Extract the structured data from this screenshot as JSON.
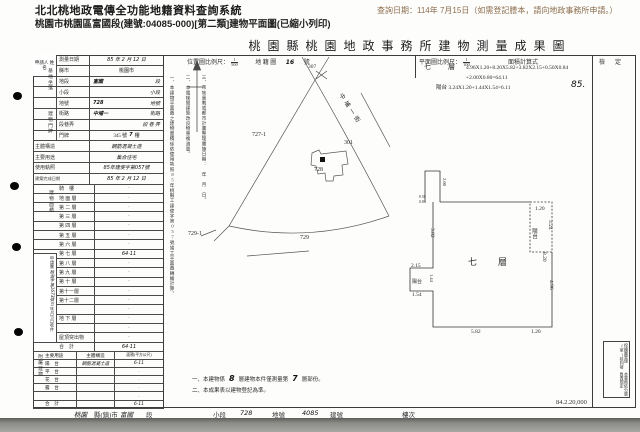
{
  "app": {
    "title": "北北桃地政電傳全功能地籍資料查詢系統",
    "query_note": "查詢日期：114年 7月15日（如需登記謄本，請向地政事務所申請。）",
    "subtitle": "桃園市桃園區富國段(建號:04085-000)[第二類]建物平面圖(已縮小列印)"
  },
  "doc": {
    "title": "桃園縣桃園地政事務所建物測量成果圖",
    "applicant_label": "申請人 姓名",
    "info": {
      "survey_date_label": "測量日期",
      "survey_date": "85 年 2 月 12 日",
      "group_site": "基地坐落",
      "group_door": "建物門牌",
      "county_label": "縣市",
      "county": "桃園市",
      "sect_label": "地段",
      "sect": "富國",
      "sect_suffix": "段",
      "subsect_label": "小段",
      "subsect_suffix": "小段",
      "parcel_label": "地號",
      "parcel": "728",
      "parcel_suffix": "地號",
      "street_label": "街路",
      "street": "中埔一",
      "street_suffix": "街路",
      "lane_label": "段巷弄",
      "lane_suffix": "段  巷  弄",
      "door_label": "門牌",
      "door": "345 號",
      "door_hw": "7",
      "door_suffix": "樓",
      "structure_label": "主體構造",
      "structure": "鋼筋混凝土造",
      "use_label": "主要用途",
      "use": "集合住宅",
      "license_label": "使用執照",
      "license": "85年建使字第057號",
      "complete_label": "建築完成日期",
      "complete": "85 年 2 月 12 日"
    },
    "floor_area_label": "建物面積",
    "floors": [
      {
        "label": "騎　樓",
        "value": "·"
      },
      {
        "label": "地 面 層",
        "value": "·"
      },
      {
        "label": "第 二 層",
        "value": "·"
      },
      {
        "label": "第 三 層",
        "value": "·"
      },
      {
        "label": "第 四 層",
        "value": "·"
      },
      {
        "label": "第 五 層",
        "value": "·"
      },
      {
        "label": "第 六 層",
        "value": "·"
      },
      {
        "label": "第 七 層",
        "value": "64·11",
        "hw": true
      },
      {
        "label": "第 八 層",
        "value": "·"
      },
      {
        "label": "第 九 層",
        "value": "·"
      },
      {
        "label": "第 十 層",
        "value": "·"
      },
      {
        "label": "第十一層",
        "value": "·"
      },
      {
        "label": "第十二層",
        "value": "·"
      },
      {
        "label": "",
        "value": "·"
      },
      {
        "label": "地 下 層",
        "value": "·"
      },
      {
        "label": "",
        "value": "·"
      },
      {
        "label": "屋頂突出物",
        "value": "·"
      },
      {
        "label": "合　計",
        "value": "64·11",
        "hw": true
      }
    ],
    "annex_label": "附屬建物",
    "annex_header": {
      "use": "主要用途",
      "structure": "主體構造",
      "area": "面積(平方公尺)"
    },
    "annex_rows": [
      {
        "use": "陽　台",
        "structure": "鋼筋混凝土造",
        "area": "6·11",
        "hw": true
      },
      {
        "use": "平　台",
        "structure": "",
        "area": "·"
      },
      {
        "use": "花　台",
        "structure": "",
        "area": "·"
      },
      {
        "use": "露　台",
        "structure": "",
        "area": "·"
      },
      {
        "use": "",
        "structure": "",
        "area": "·"
      },
      {
        "use": "合　計",
        "structure": "",
        "area": "6·11",
        "hw": true
      }
    ],
    "receipt": {
      "title": "申請書",
      "ref": "桃測字第1673號",
      "date": "85年2月5日收件"
    },
    "map_header": {
      "scale_label": "位置圖比例尺：",
      "scale_num": "1",
      "scale_den": "500",
      "cad_label": "地 籍 圖",
      "cad_no": "16",
      "cad_suffix": "號",
      "cad_sheet": "307"
    },
    "plan_header": {
      "scale_label": "平面圖比例尺：",
      "scale_num": "1",
      "scale_den": "100",
      "formula_label": "面積計算式"
    },
    "formula": {
      "floor_label": "七　層",
      "line1": "4.96X1.20+8.20X5.82+3.82X2.15+0.50X0.84",
      "line2": "+2.00X0.80=64.11",
      "line3": "陽台 3.24X1.20+1.44X1.54=6.11",
      "stamp": "85."
    },
    "check_label": "檢定",
    "map_labels": {
      "p727": "727-1",
      "p301": "301",
      "p728": "728",
      "p729": "729",
      "p729_1": "729-1",
      "road": "中埔一街"
    },
    "fp": {
      "floor": "七　層",
      "balcony_r": "陽台",
      "balcony_l": "陽台",
      "d_120t": "1.20",
      "d_324": "3.24",
      "d_382": "3.82",
      "d_820": "8.20",
      "d_496": "4.96",
      "d_582": "5.82",
      "d_120b": "1.20",
      "d_215": "2.15",
      "d_144": "1.44",
      "d_154": "1.54",
      "d_200": "2.00",
      "d_050": "0.50",
      "d_084": "0.84"
    },
    "notes_vertical": [
      "一、本建物平面圖之建物面積係依使用執照85年桃縣工建使字第057號竣工平面圖轉繪計算。",
      "二、本電梯間建築改良物重複測量。",
      "三、市地重劃或都市計畫整理實施日期：　年　月　日。"
    ],
    "notes_bottom": {
      "n1a": "一、本建物係",
      "n1_hw1": "8",
      "n1b": "層建物本件僅測量第",
      "n1_hw2": "7",
      "n1c": "層部份。",
      "n2": "二、本成果表以建物登記為準。"
    },
    "footer": {
      "county_hw": "桃園",
      "county": "縣(鎮)市",
      "sect_hw": "富國",
      "sect": "段",
      "subsect": "小段",
      "parcel_hw": "728",
      "parcel": "地號",
      "bldg_hw": "4085",
      "bldg": "建號",
      "floor": "樓次",
      "print_code": "84.2.20,000"
    },
    "stamp_box": {
      "right": "校繪圖管理(室)核判發",
      "left": "本業務依分層負責規定"
    }
  }
}
